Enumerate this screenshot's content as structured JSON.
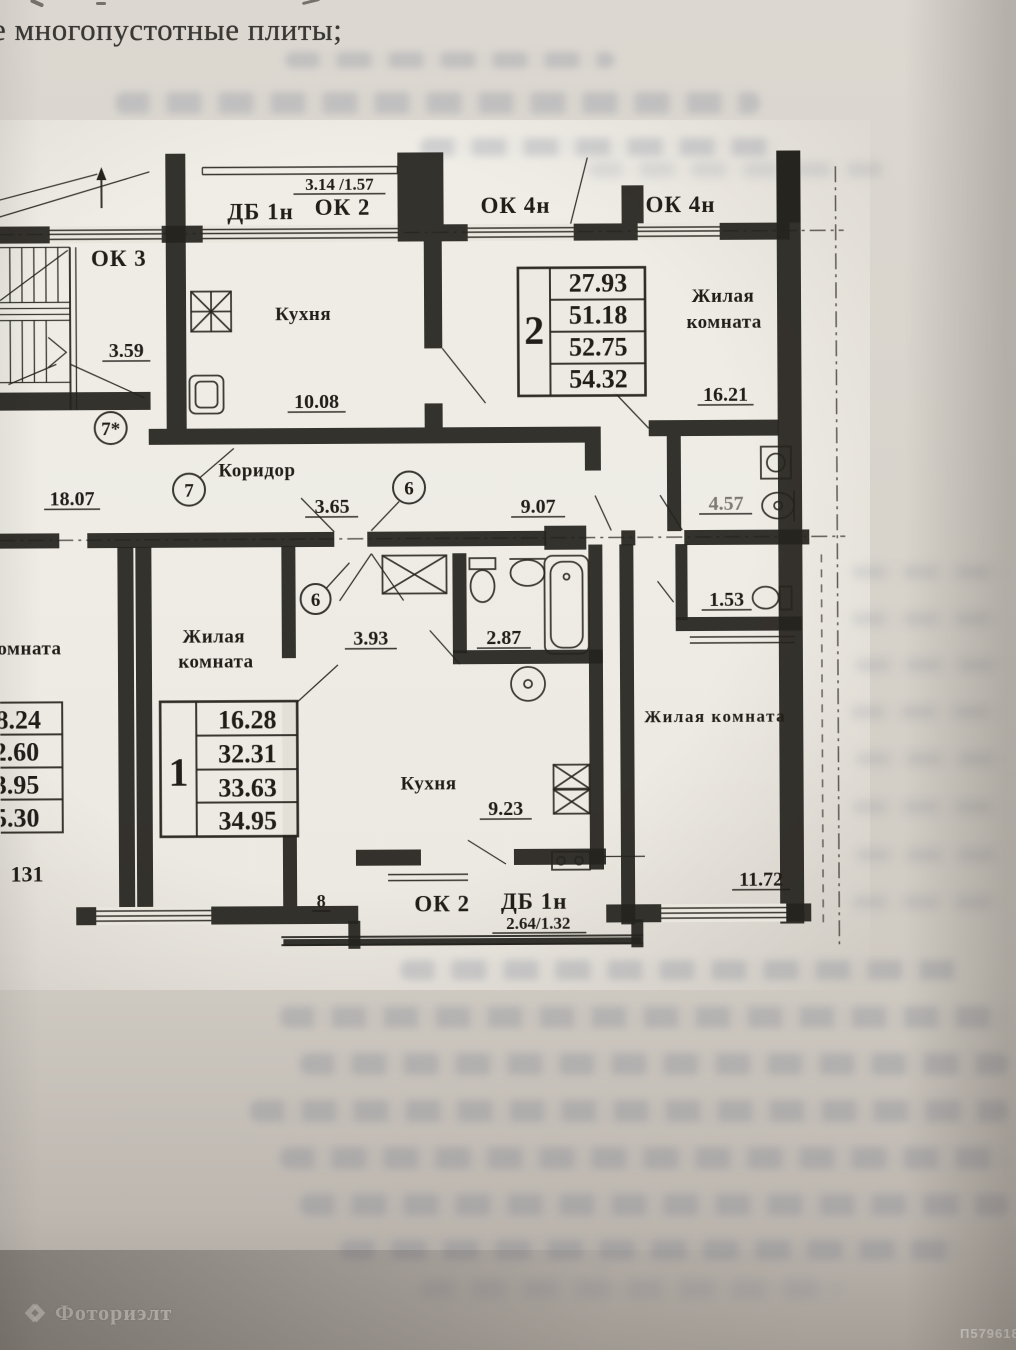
{
  "document": {
    "heading_fragment": "е многопустотные плиты;"
  },
  "watermark": {
    "brand": "Фоториэлт",
    "photo_id": "П579618"
  },
  "plan": {
    "windows": {
      "ok3": "ОК 3",
      "db1n_top": "ДБ 1н",
      "ok2_top": "ОК 2",
      "top_window_dim": "3.14 /1.57",
      "ok4n_left": "ОК 4н",
      "ok4n_right": "ОК 4н",
      "ok2_bottom": "ОК 2",
      "db1n_bottom": "ДБ 1н",
      "bottom_window_dim": "2.64/1.32"
    },
    "rooms": {
      "kitchen_top": "Кухня",
      "living_top_1": "Жилая",
      "living_top_2": "комната",
      "corridor": "Коридор",
      "living_apt1_1": "Жилая",
      "living_apt1_2": "комната",
      "kitchen_bottom": "Кухня",
      "living_right": "Жилая комната",
      "left_room_fragment": "комната"
    },
    "dims": {
      "stair": "3.59",
      "kitchen_top": "10.08",
      "living_top": "16.21",
      "corridor_left": "18.07",
      "corridor_mid": "3.65",
      "corridor_right": "9.07",
      "bath_top_right": "4.57",
      "wc_right": "1.53",
      "hall_apt1": "3.93",
      "bath_apt1": "2.87",
      "kitchen_apt1": "9.23",
      "living_right": "11.72",
      "wall_small": "8"
    },
    "axes": {
      "left_star": "7*",
      "left": "7",
      "mid": "6",
      "mid_lower": "6"
    },
    "apt2": {
      "number": "2",
      "areas": [
        "27.93",
        "51.18",
        "52.75",
        "54.32"
      ]
    },
    "apt1": {
      "number": "1",
      "areas": [
        "16.28",
        "32.31",
        "33.63",
        "34.95"
      ]
    },
    "apt_left": {
      "areas": [
        "8.24",
        "2.60",
        "3.95",
        "5.30"
      ],
      "note": "131"
    }
  }
}
